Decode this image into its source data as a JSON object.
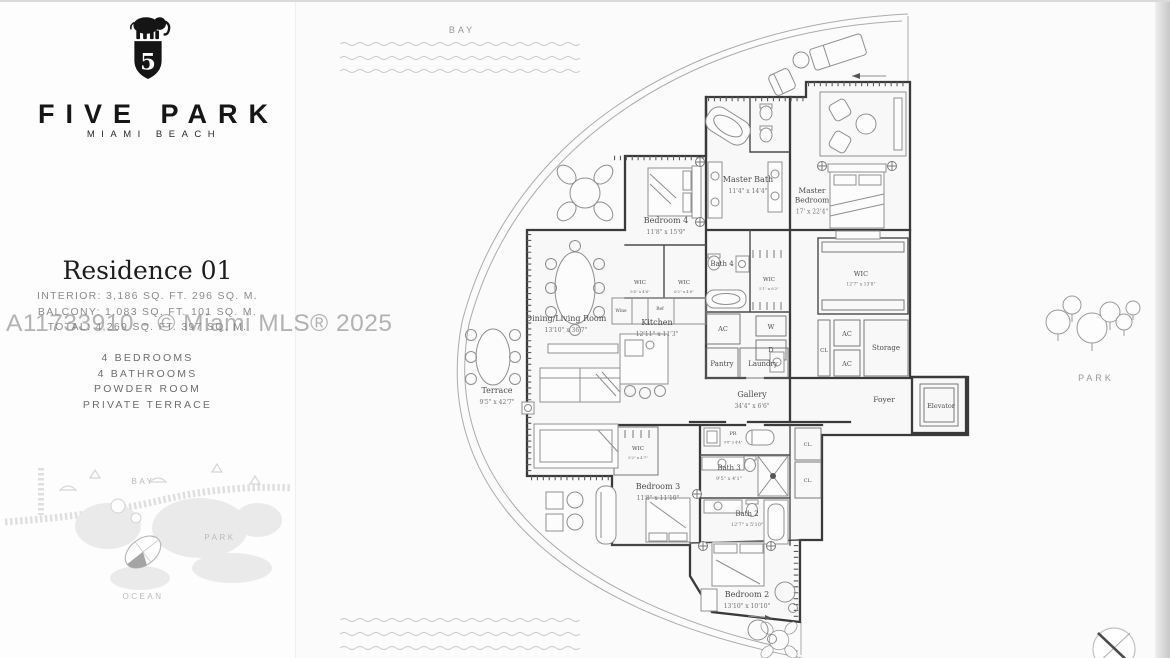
{
  "watermark": "A11733910 - © Miami MLS® 2025",
  "sidebar": {
    "logo": "elephant-shield-5-icon",
    "brand_name": "FIVE PARK",
    "brand_sub": "MIAMI BEACH",
    "residence_title": "Residence 01",
    "stats": {
      "interior": "INTERIOR: 3,186 SQ. FT.   296 SQ. M.",
      "balcony": "BALCONY: 1,083 SQ. FT.   101 SQ. M.",
      "total": "TOTAL: 4,269 SQ. FT.   397 SQ. M."
    },
    "features": [
      "4 BEDROOMS",
      "4 BATHROOMS",
      "POWDER ROOM",
      "PRIVATE TERRACE"
    ],
    "key_map": {
      "bay": "BAY",
      "park": "PARK",
      "ocean": "OCEAN"
    }
  },
  "plan": {
    "bay_label": "BAY",
    "park_label": "PARK",
    "rooms": [
      {
        "lines": [
          "Master Bath"
        ],
        "dims": "11'4\" x 14'4\"",
        "x": 748,
        "y": 182,
        "fs": 8,
        "dfs": 6
      },
      {
        "lines": [
          "Master",
          "Bedroom"
        ],
        "dims": "17' x 22'4\"",
        "x": 812,
        "y": 193,
        "fs": 7.5,
        "dfs": 6
      },
      {
        "lines": [
          "Bedroom 4"
        ],
        "dims": "11'8\" x 15'9\"",
        "x": 666,
        "y": 223,
        "fs": 8,
        "dfs": 6
      },
      {
        "lines": [
          "Bath 4"
        ],
        "x": 722,
        "y": 266,
        "fs": 7
      },
      {
        "lines": [
          "WIC"
        ],
        "dims": "5'4\" x 4'6\"",
        "x": 640,
        "y": 284,
        "fs": 5.5,
        "dfs": 3.8
      },
      {
        "lines": [
          "WIC"
        ],
        "dims": "6'2\" x 4'6\"",
        "x": 684,
        "y": 284,
        "fs": 5.5,
        "dfs": 3.8
      },
      {
        "lines": [
          "WIC"
        ],
        "dims": "5'1\" x 6'2\"",
        "x": 769,
        "y": 281,
        "fs": 5.5,
        "dfs": 3.8
      },
      {
        "lines": [
          "Kitchen"
        ],
        "dims": "12'11\" x 11'3\"",
        "x": 657,
        "y": 325,
        "fs": 8,
        "dfs": 6
      },
      {
        "lines": [
          "Dining/Living Room"
        ],
        "dims": "13'10\" x 36'7\"",
        "x": 566,
        "y": 321,
        "fs": 8,
        "dfs": 6
      },
      {
        "lines": [
          "Terrace"
        ],
        "dims": "9'5\" x 42'7\"",
        "x": 497,
        "y": 393,
        "fs": 8,
        "dfs": 6
      },
      {
        "lines": [
          "AC"
        ],
        "x": 723,
        "y": 331,
        "fs": 6.5
      },
      {
        "lines": [
          "W"
        ],
        "x": 771,
        "y": 329,
        "fs": 6.5
      },
      {
        "lines": [
          "D"
        ],
        "x": 771,
        "y": 352,
        "fs": 6.5
      },
      {
        "lines": [
          "Pantry"
        ],
        "x": 722,
        "y": 366,
        "fs": 7
      },
      {
        "lines": [
          "Laundry"
        ],
        "x": 763,
        "y": 366,
        "fs": 7
      },
      {
        "lines": [
          "WIC"
        ],
        "dims": "12'7\" x 13'8\"",
        "x": 861,
        "y": 276,
        "fs": 6.5,
        "dfs": 4.5
      },
      {
        "lines": [
          "CL"
        ],
        "x": 824,
        "y": 352,
        "fs": 5.5
      },
      {
        "lines": [
          "AC"
        ],
        "x": 847,
        "y": 336,
        "fs": 6.5
      },
      {
        "lines": [
          "AC"
        ],
        "x": 847,
        "y": 366,
        "fs": 6.5
      },
      {
        "lines": [
          "Storage"
        ],
        "x": 886,
        "y": 350,
        "fs": 7
      },
      {
        "lines": [
          "Gallery"
        ],
        "dims": "34'4\" x 6'6\"",
        "x": 752,
        "y": 397,
        "fs": 8,
        "dfs": 6
      },
      {
        "lines": [
          "Foyer"
        ],
        "x": 884,
        "y": 402,
        "fs": 7.5
      },
      {
        "lines": [
          "Elevator"
        ],
        "x": 941,
        "y": 408,
        "fs": 6.5
      },
      {
        "lines": [
          "PR"
        ],
        "dims": "9'8\" x 4'4\"",
        "x": 733,
        "y": 435,
        "fs": 5,
        "dfs": 3.6
      },
      {
        "lines": [
          "CL."
        ],
        "x": 808,
        "y": 446,
        "fs": 5
      },
      {
        "lines": [
          "CL."
        ],
        "x": 808,
        "y": 482,
        "fs": 5
      },
      {
        "lines": [
          "WIC"
        ],
        "dims": "5'2\" x 4'7\"",
        "x": 638,
        "y": 450,
        "fs": 5.5,
        "dfs": 3.8
      },
      {
        "lines": [
          "Bath 3"
        ],
        "dims": "9'5\" x 4'1\"",
        "x": 729,
        "y": 470,
        "fs": 7,
        "dfs": 5
      },
      {
        "lines": [
          "Bedroom 3"
        ],
        "dims": "11'8\" x 11'10\"",
        "x": 658,
        "y": 489,
        "fs": 8,
        "dfs": 6
      },
      {
        "lines": [
          "Bath 2"
        ],
        "dims": "12'7\" x 5'10\"",
        "x": 747,
        "y": 516,
        "fs": 7,
        "dfs": 5
      },
      {
        "lines": [
          "Bedroom 2"
        ],
        "dims": "13'10\" x 10'10\"",
        "x": 747,
        "y": 597,
        "fs": 8,
        "dfs": 6
      },
      {
        "lines": [
          "Wine"
        ],
        "x": 621,
        "y": 312,
        "fs": 4.4
      },
      {
        "lines": [
          "Ref"
        ],
        "x": 660,
        "y": 310,
        "fs": 4.4
      }
    ]
  }
}
